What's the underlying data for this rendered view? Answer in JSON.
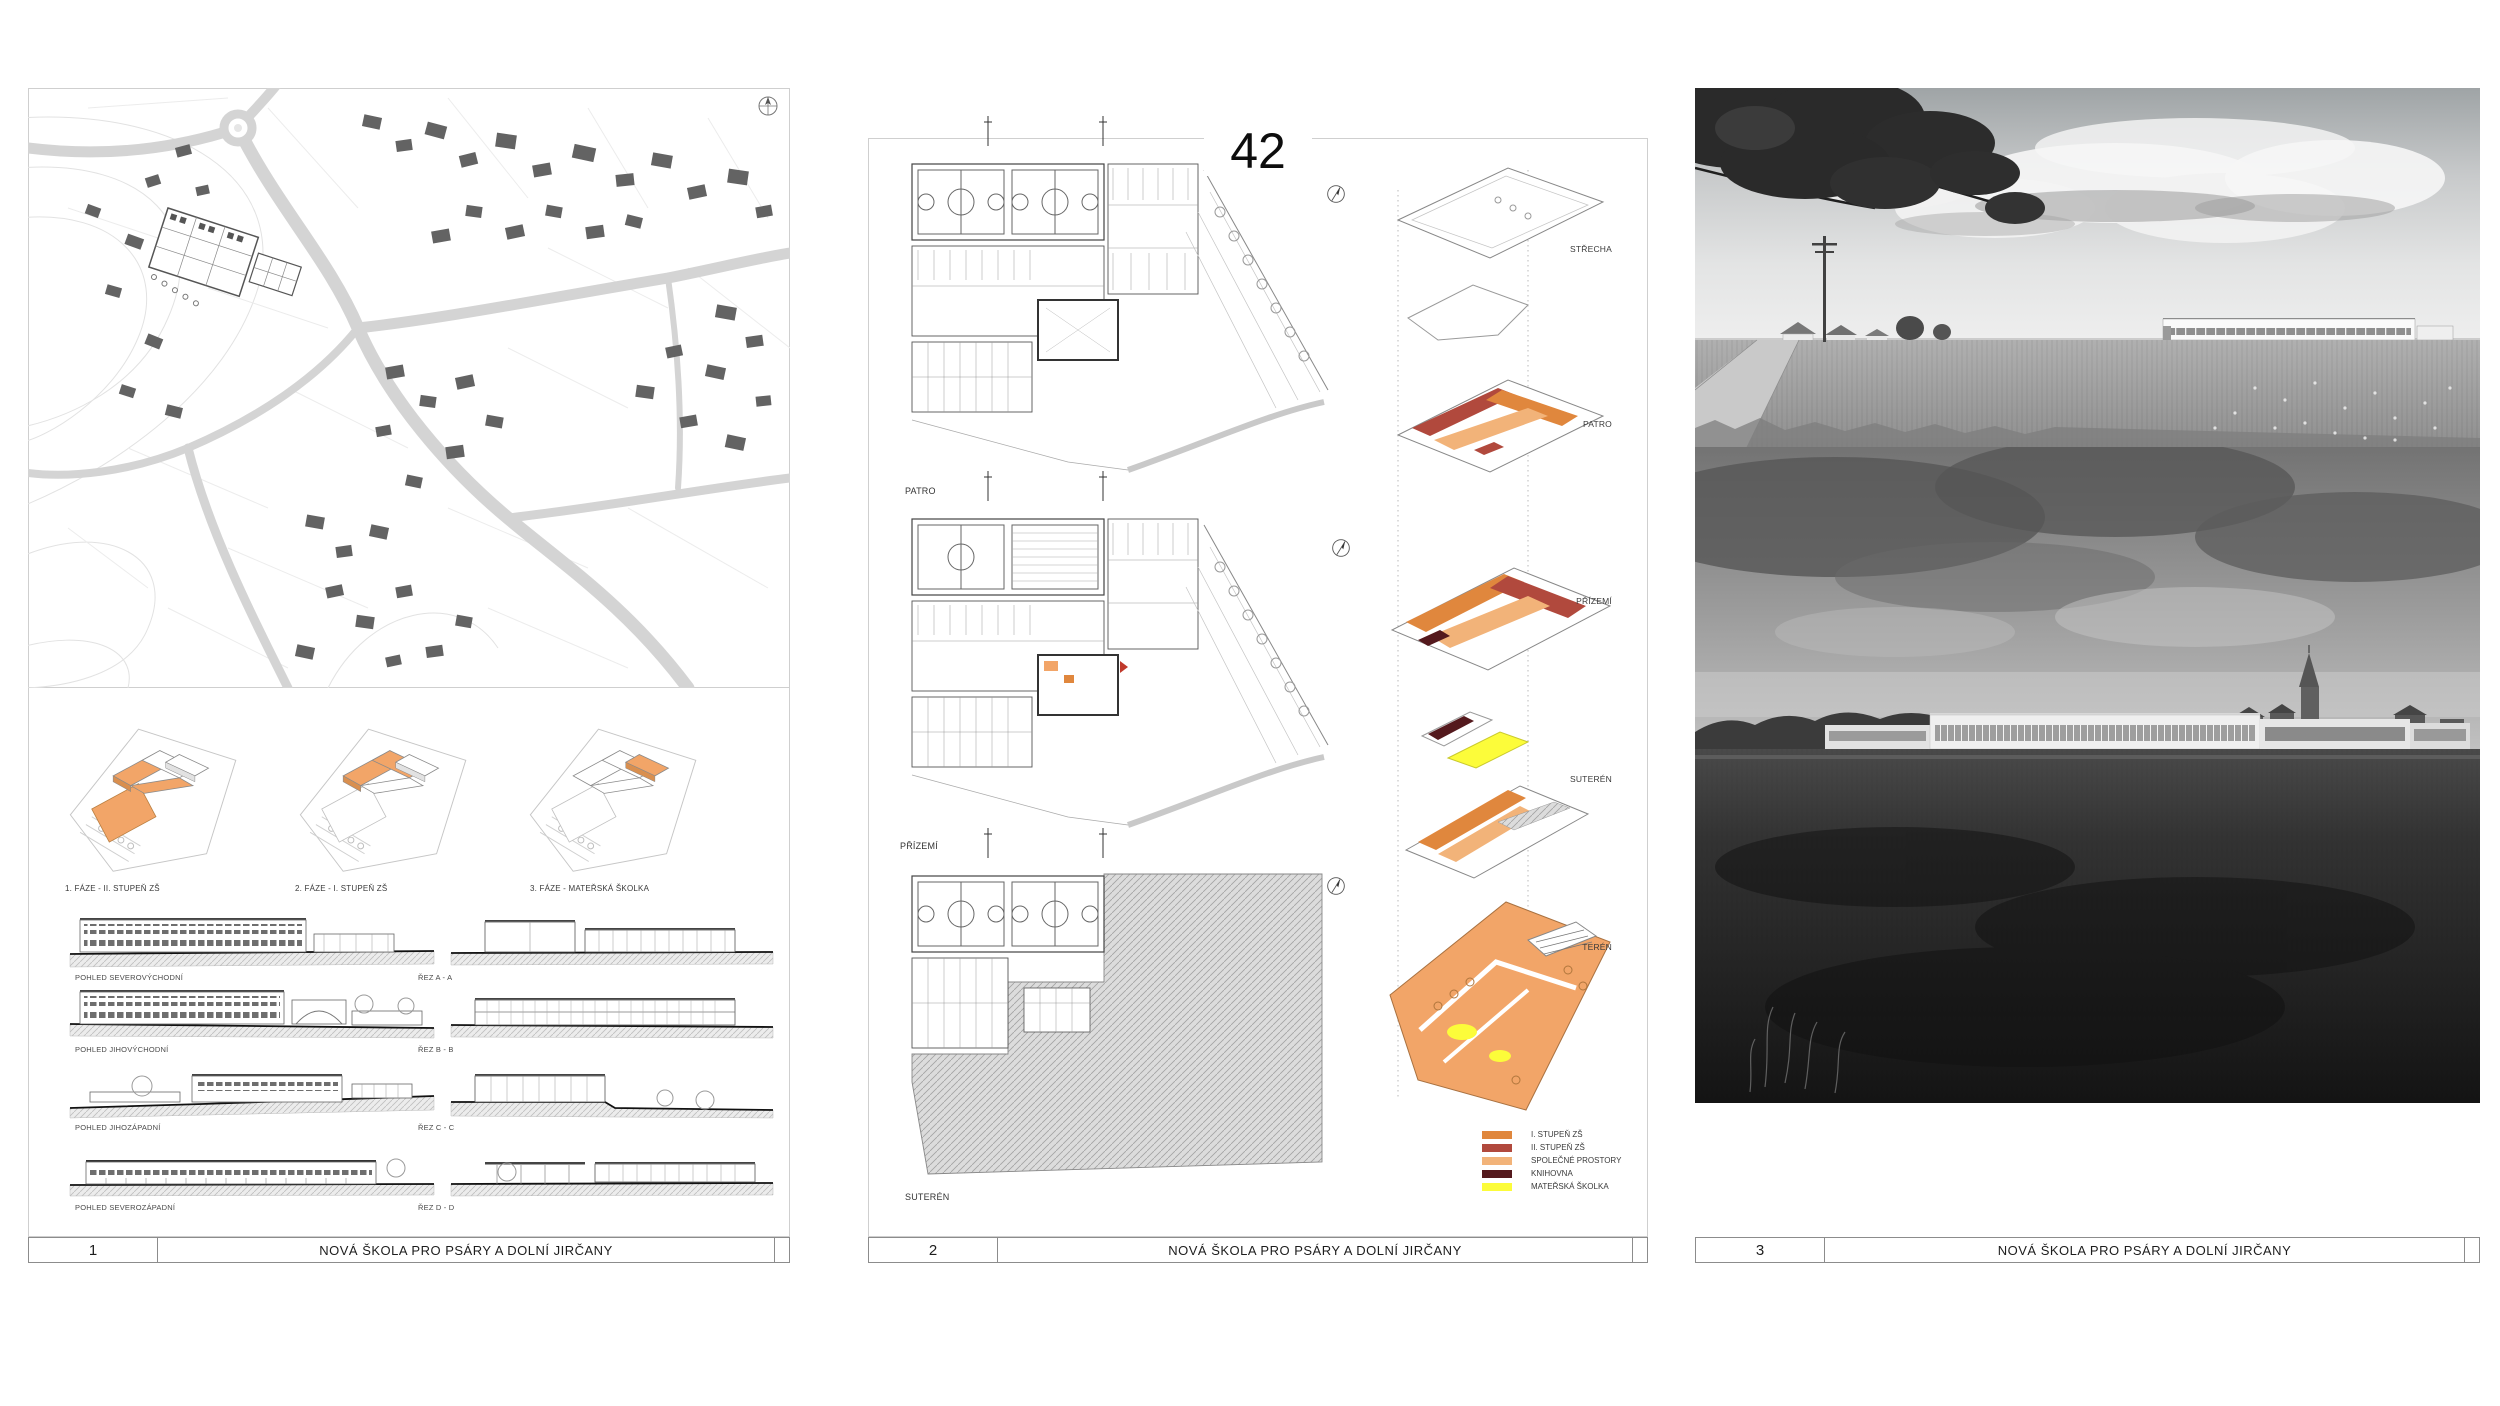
{
  "board": {
    "entry_number": "42",
    "project_title": "NOVÁ ŠKOLA PRO PSÁRY A DOLNÍ JIRČANY"
  },
  "panel1": {
    "number": "1",
    "title": "NOVÁ ŠKOLA PRO PSÁRY A DOLNÍ JIRČANY",
    "phases": [
      "1. FÁZE - II. STUPEŇ ZŠ",
      "2. FÁZE - I. STUPEŇ ZŠ",
      "3. FÁZE - MATEŘSKÁ ŠKOLKA"
    ],
    "elevations": [
      "POHLED SEVEROVÝCHODNÍ",
      "POHLED JIHOVÝCHODNÍ",
      "POHLED JIHOZÁPADNÍ",
      "POHLED SEVEROZÁPADNÍ"
    ],
    "sections": [
      "ŘEZ A - A",
      "ŘEZ B - B",
      "ŘEZ C - C",
      "ŘEZ D - D"
    ]
  },
  "panel2": {
    "number": "2",
    "title": "NOVÁ ŠKOLA PRO PSÁRY A DOLNÍ JIRČANY",
    "plans": [
      "PATRO",
      "PŘÍZEMÍ",
      "SUTERÉN"
    ],
    "axon_levels": [
      "STŘECHA",
      "PATRO",
      "PŘÍZEMÍ",
      "SUTERÉN",
      "TERÉN"
    ],
    "legend": [
      {
        "label": "I. STUPEŇ ZŠ",
        "color": "#E0873D"
      },
      {
        "label": "II. STUPEŇ ZŠ",
        "color": "#B1493D"
      },
      {
        "label": "SPOLEČNÉ PROSTORY",
        "color": "#F2B379"
      },
      {
        "label": "KNIHOVNA",
        "color": "#54191D"
      },
      {
        "label": "MATEŘSKÁ ŠKOLKA",
        "color": "#FCFC3A"
      }
    ]
  },
  "panel3": {
    "number": "3",
    "title": "NOVÁ ŠKOLA PRO PSÁRY A DOLNÍ JIRČANY"
  },
  "colors": {
    "highlight_orange": "#F2A568",
    "brick_red": "#B1493D",
    "yellow": "#FCFC3A"
  }
}
